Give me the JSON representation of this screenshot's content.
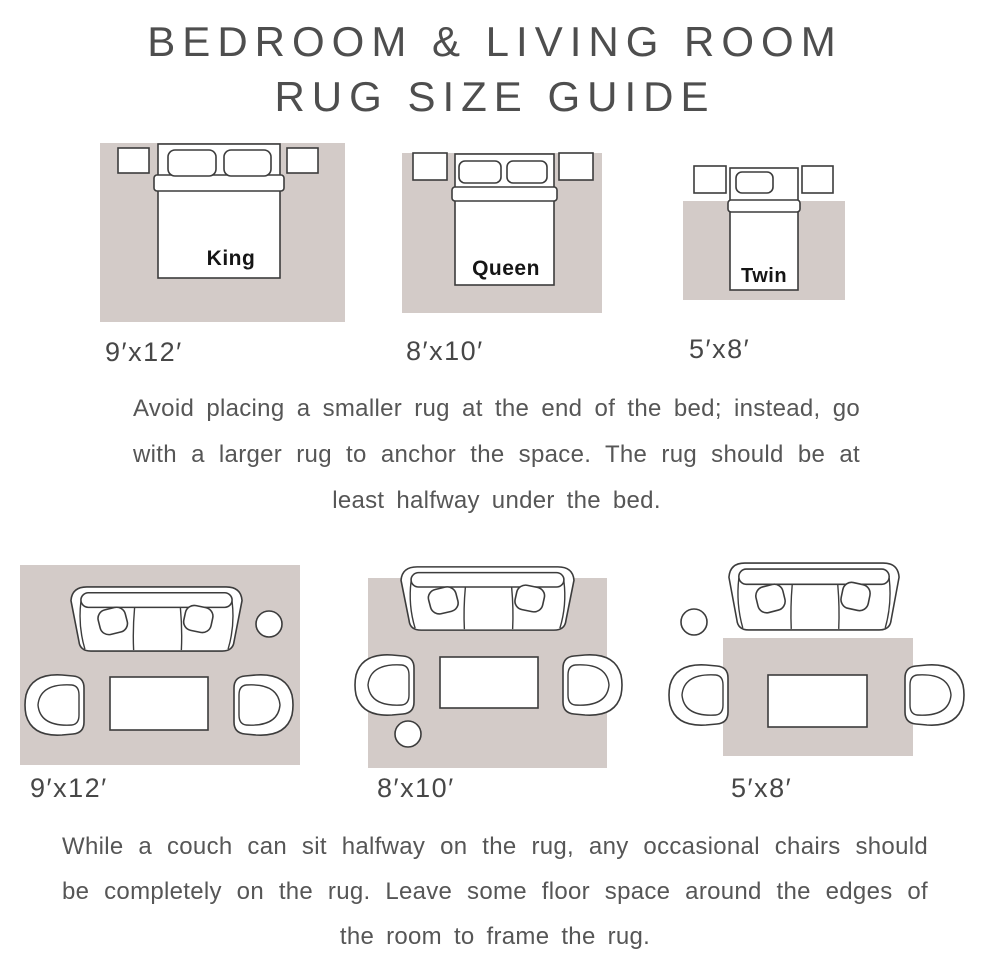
{
  "title": {
    "line1": "BEDROOM & LIVING ROOM",
    "line2": "RUG SIZE GUIDE"
  },
  "colors": {
    "rug": "#d3cbc8",
    "outline": "#3c3c3c",
    "heading_text": "#4e4e4e",
    "body_text": "#565656",
    "bed_label_text": "#151515"
  },
  "bedroom_section": {
    "diagrams": [
      {
        "bed_label": "King",
        "rug_size": "9′x12′"
      },
      {
        "bed_label": "Queen",
        "rug_size": "8′x10′"
      },
      {
        "bed_label": "Twin",
        "rug_size": "5′x8′"
      }
    ],
    "note": "Avoid placing a smaller rug at the end of the bed; instead, go with a larger rug to anchor the space. The rug should be at least halfway under the bed."
  },
  "living_section": {
    "diagrams": [
      {
        "rug_size": "9′x12′"
      },
      {
        "rug_size": "8′x10′"
      },
      {
        "rug_size": "5′x8′"
      }
    ],
    "note": "While a couch can sit halfway on the rug, any occasional chairs should be completely on the rug. Leave some floor space around the edges of the room to frame the rug."
  }
}
